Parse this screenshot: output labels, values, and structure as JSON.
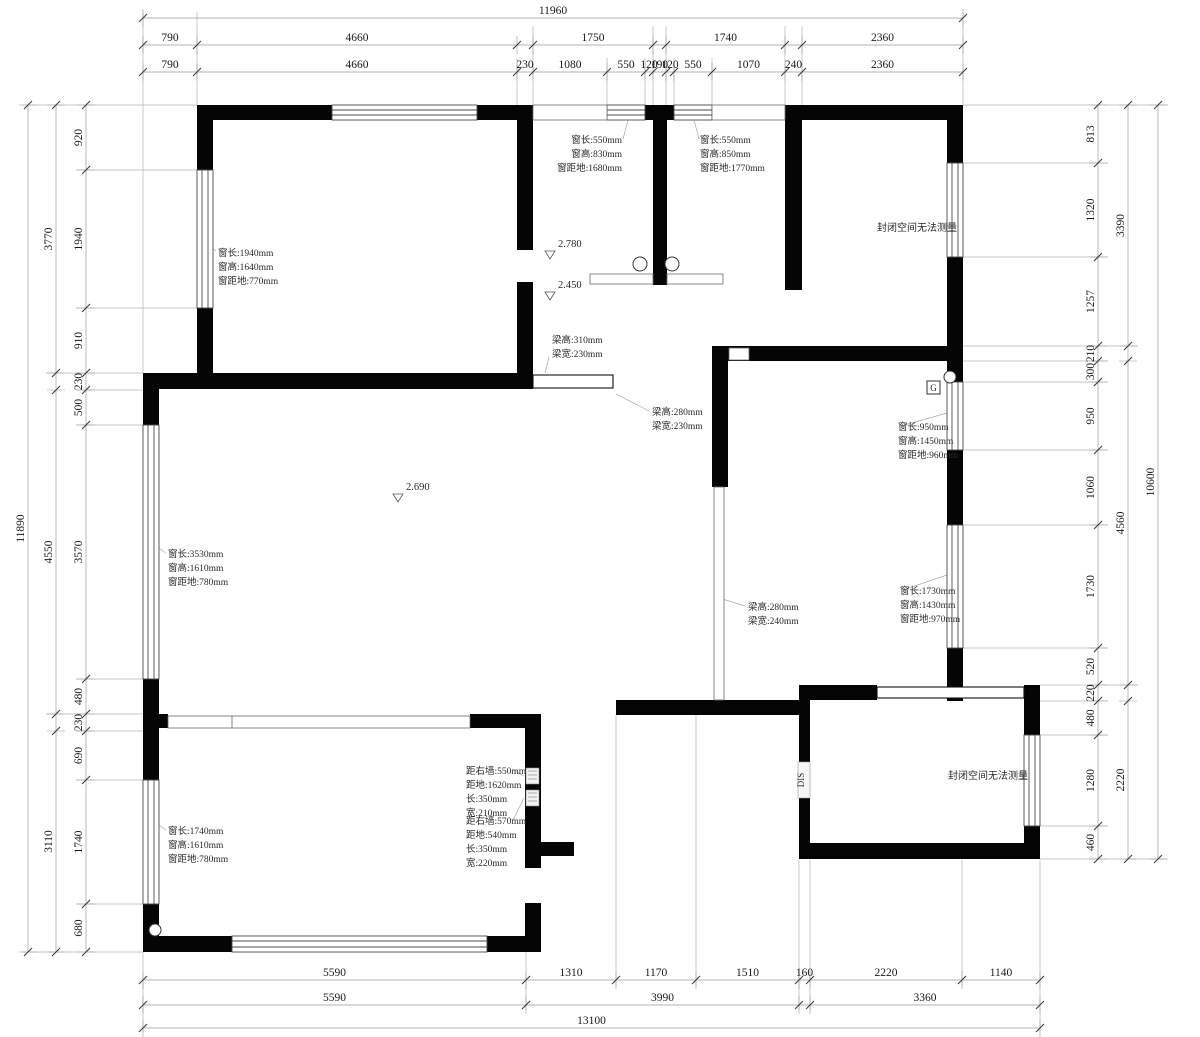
{
  "drawing": {
    "type": "floor-plan-measurement",
    "wall_color": "#050505",
    "dim_line_color": "#9a9a9a",
    "tick_color": "#3c3c3c"
  },
  "dim_chains": [
    {
      "name": "top-row1",
      "dir": "h",
      "base": 18,
      "segs": [
        {
          "a": 143,
          "b": 963,
          "label": "11960"
        }
      ]
    },
    {
      "name": "top-row2",
      "dir": "h",
      "base": 45,
      "segs": [
        {
          "a": 143,
          "b": 197,
          "label": "790"
        },
        {
          "a": 197,
          "b": 517,
          "label": "4660"
        },
        {
          "a": 533,
          "b": 653,
          "label": "1750"
        },
        {
          "a": 666,
          "b": 785,
          "label": "1740"
        },
        {
          "a": 802,
          "b": 963,
          "label": "2360"
        }
      ]
    },
    {
      "name": "top-row3",
      "dir": "h",
      "base": 72,
      "segs": [
        {
          "a": 143,
          "b": 197,
          "label": "790"
        },
        {
          "a": 197,
          "b": 517,
          "label": "4660"
        },
        {
          "a": 517,
          "b": 533,
          "label": "230"
        },
        {
          "a": 533,
          "b": 607,
          "label": "1080"
        },
        {
          "a": 607,
          "b": 645,
          "label": "550"
        },
        {
          "a": 645,
          "b": 653,
          "label": "120"
        },
        {
          "a": 653,
          "b": 666,
          "label": "190"
        },
        {
          "a": 666,
          "b": 674,
          "label": "120"
        },
        {
          "a": 674,
          "b": 712,
          "label": "550"
        },
        {
          "a": 712,
          "b": 785,
          "label": "1070"
        },
        {
          "a": 785,
          "b": 802,
          "label": "240"
        },
        {
          "a": 802,
          "b": 963,
          "label": "2360"
        }
      ]
    },
    {
      "name": "left-outer",
      "dir": "v",
      "base": 28,
      "segs": [
        {
          "a": 105,
          "b": 952,
          "label": "11890"
        }
      ]
    },
    {
      "name": "left-mid",
      "dir": "v",
      "base": 56,
      "segs": [
        {
          "a": 105,
          "b": 373,
          "label": "3770"
        },
        {
          "a": 390,
          "b": 714,
          "label": "4550"
        },
        {
          "a": 731,
          "b": 952,
          "label": "3110"
        }
      ]
    },
    {
      "name": "left-inner",
      "dir": "v",
      "base": 86,
      "segs": [
        {
          "a": 105,
          "b": 170,
          "label": "920"
        },
        {
          "a": 170,
          "b": 308,
          "label": "1940"
        },
        {
          "a": 308,
          "b": 373,
          "label": "910"
        },
        {
          "a": 373,
          "b": 390,
          "label": "230"
        },
        {
          "a": 390,
          "b": 425,
          "label": "500"
        },
        {
          "a": 425,
          "b": 679,
          "label": "3570"
        },
        {
          "a": 679,
          "b": 714,
          "label": "480"
        },
        {
          "a": 714,
          "b": 731,
          "label": "230"
        },
        {
          "a": 731,
          "b": 780,
          "label": "690"
        },
        {
          "a": 780,
          "b": 904,
          "label": "1740"
        },
        {
          "a": 904,
          "b": 952,
          "label": "680"
        }
      ]
    },
    {
      "name": "right-inner",
      "dir": "v",
      "base": 1098,
      "segs": [
        {
          "a": 105,
          "b": 163,
          "label": "813"
        },
        {
          "a": 163,
          "b": 257,
          "label": "1320"
        },
        {
          "a": 257,
          "b": 346,
          "label": "1257"
        },
        {
          "a": 346,
          "b": 361,
          "label": "210"
        },
        {
          "a": 361,
          "b": 382,
          "label": "300"
        },
        {
          "a": 382,
          "b": 450,
          "label": "950"
        },
        {
          "a": 450,
          "b": 525,
          "label": "1060"
        },
        {
          "a": 525,
          "b": 648,
          "label": "1730"
        },
        {
          "a": 648,
          "b": 685,
          "label": "520"
        },
        {
          "a": 685,
          "b": 701,
          "label": "220"
        },
        {
          "a": 701,
          "b": 735,
          "label": "480"
        },
        {
          "a": 735,
          "b": 826,
          "label": "1280"
        },
        {
          "a": 826,
          "b": 859,
          "label": "460"
        }
      ]
    },
    {
      "name": "right-mid",
      "dir": "v",
      "base": 1128,
      "segs": [
        {
          "a": 105,
          "b": 346,
          "label": "3390"
        },
        {
          "a": 361,
          "b": 685,
          "label": "4560"
        },
        {
          "a": 701,
          "b": 859,
          "label": "2220"
        }
      ]
    },
    {
      "name": "right-outer",
      "dir": "v",
      "base": 1158,
      "segs": [
        {
          "a": 105,
          "b": 859,
          "label": "10600"
        }
      ]
    },
    {
      "name": "bottom-row1",
      "dir": "h",
      "base": 980,
      "segs": [
        {
          "a": 143,
          "b": 526,
          "label": "5590"
        },
        {
          "a": 526,
          "b": 616,
          "label": "1310"
        },
        {
          "a": 616,
          "b": 696,
          "label": "1170"
        },
        {
          "a": 696,
          "b": 799,
          "label": "1510"
        },
        {
          "a": 799,
          "b": 810,
          "label": "160"
        },
        {
          "a": 810,
          "b": 962,
          "label": "2220"
        },
        {
          "a": 962,
          "b": 1040,
          "label": "1140"
        }
      ]
    },
    {
      "name": "bottom-row2",
      "dir": "h",
      "base": 1005,
      "segs": [
        {
          "a": 143,
          "b": 526,
          "label": "5590"
        },
        {
          "a": 526,
          "b": 799,
          "label": "3990"
        },
        {
          "a": 810,
          "b": 1040,
          "label": "3360"
        }
      ]
    },
    {
      "name": "bottom-row3",
      "dir": "h",
      "base": 1028,
      "segs": [
        {
          "a": 143,
          "b": 1040,
          "label": "13100"
        }
      ]
    }
  ],
  "annotations": [
    {
      "name": "window-top-left-room",
      "x": 218,
      "y": 256,
      "align": "start",
      "lines": [
        "窗长:1940mm",
        "窗高:1640mm",
        "窗距地:770mm"
      ]
    },
    {
      "name": "window-bath-left",
      "x": 622,
      "y": 143,
      "align": "end",
      "lines": [
        "窗长:550mm",
        "窗高:830mm",
        "窗距地:1680mm"
      ]
    },
    {
      "name": "window-bath-right",
      "x": 700,
      "y": 143,
      "align": "start",
      "lines": [
        "窗长:550mm",
        "窗高:850mm",
        "窗距地:1770mm"
      ]
    },
    {
      "name": "note-sealed-top-right",
      "x": 917,
      "y": 231,
      "align": "middle",
      "lines": [
        "封闭空间无法测量"
      ]
    },
    {
      "name": "beam-1",
      "x": 552,
      "y": 343,
      "align": "start",
      "lines": [
        "梁高:310mm",
        "梁宽:230mm"
      ]
    },
    {
      "name": "beam-2",
      "x": 652,
      "y": 415,
      "align": "start",
      "lines": [
        "梁高:280mm",
        "梁宽:230mm"
      ]
    },
    {
      "name": "window-right-room-1",
      "x": 898,
      "y": 430,
      "align": "start",
      "lines": [
        "窗长:950mm",
        "窗高:1450mm",
        "窗距地:960mm"
      ]
    },
    {
      "name": "window-right-room-2",
      "x": 900,
      "y": 594,
      "align": "start",
      "lines": [
        "窗长:1730mm",
        "窗高:1430mm",
        "窗距地:970mm"
      ]
    },
    {
      "name": "beam-3",
      "x": 748,
      "y": 610,
      "align": "start",
      "lines": [
        "梁高:280mm",
        "梁宽:240mm"
      ]
    },
    {
      "name": "window-living-left",
      "x": 168,
      "y": 557,
      "align": "start",
      "lines": [
        "窗长:3530mm",
        "窗高:1610mm",
        "窗距地:780mm"
      ]
    },
    {
      "name": "measure-box-1",
      "x": 466,
      "y": 774,
      "align": "start",
      "lines": [
        "距右墙:550mm",
        "距地:1620mm",
        "长:350mm",
        "宽:210mm"
      ]
    },
    {
      "name": "measure-box-2",
      "x": 466,
      "y": 824,
      "align": "start",
      "lines": [
        "距右墙:570mm",
        "距地:540mm",
        "长:350mm",
        "宽:220mm"
      ]
    },
    {
      "name": "window-bottom-left-room",
      "x": 168,
      "y": 834,
      "align": "start",
      "lines": [
        "窗长:1740mm",
        "窗高:1610mm",
        "窗距地:780mm"
      ]
    },
    {
      "name": "note-sealed-bottom-right",
      "x": 948,
      "y": 779,
      "align": "start",
      "lines": [
        "封闭空间无法测量"
      ]
    }
  ],
  "levels": [
    {
      "name": "level-bath",
      "label": "2.780",
      "x": 558,
      "y": 247
    },
    {
      "name": "level-bath-low",
      "label": "2.450",
      "x": 558,
      "y": 288
    },
    {
      "name": "level-living",
      "label": "2.690",
      "x": 406,
      "y": 490
    }
  ],
  "markers": {
    "g_label": "G",
    "dis_label": "DIS"
  }
}
